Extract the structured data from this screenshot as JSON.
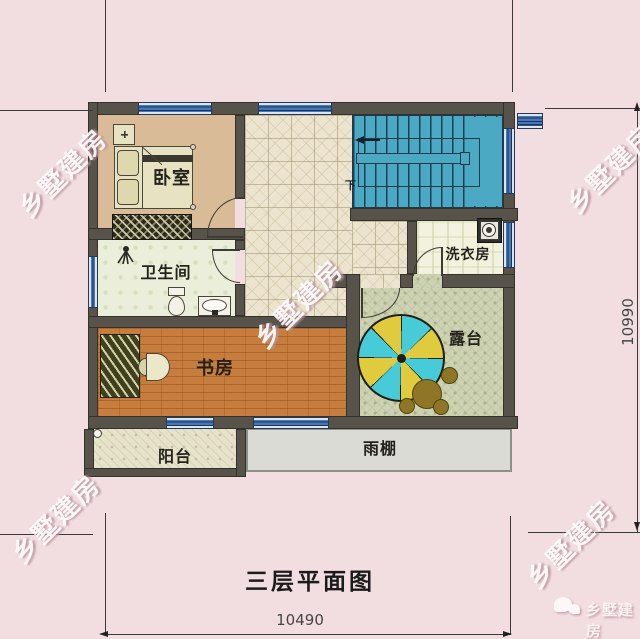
{
  "title": "三层平面图",
  "dimensions": {
    "bottom": "10490",
    "right": "10990"
  },
  "rooms": {
    "bedroom": "卧室",
    "bathroom": "卫生间",
    "study": "书房",
    "balcony": "阳台",
    "canopy": "雨棚",
    "laundry": "洗衣房",
    "terrace": "露台"
  },
  "stairs": {
    "down_label": "下"
  },
  "watermark": {
    "text": "乡墅建房"
  },
  "brand": {
    "text": "乡墅建房"
  },
  "colors": {
    "background": "#f2dee0",
    "wall": "#57534a",
    "window_blue": "#4878b8",
    "stair_teal": "#4ca9c4",
    "bedroom_floor": "#dabb98",
    "study_floor": "#c67d3e",
    "terrace_floor": "#cdd2b2",
    "umbrella_cyan": "#48cbd8",
    "umbrella_yellow": "#dfcb3d"
  }
}
